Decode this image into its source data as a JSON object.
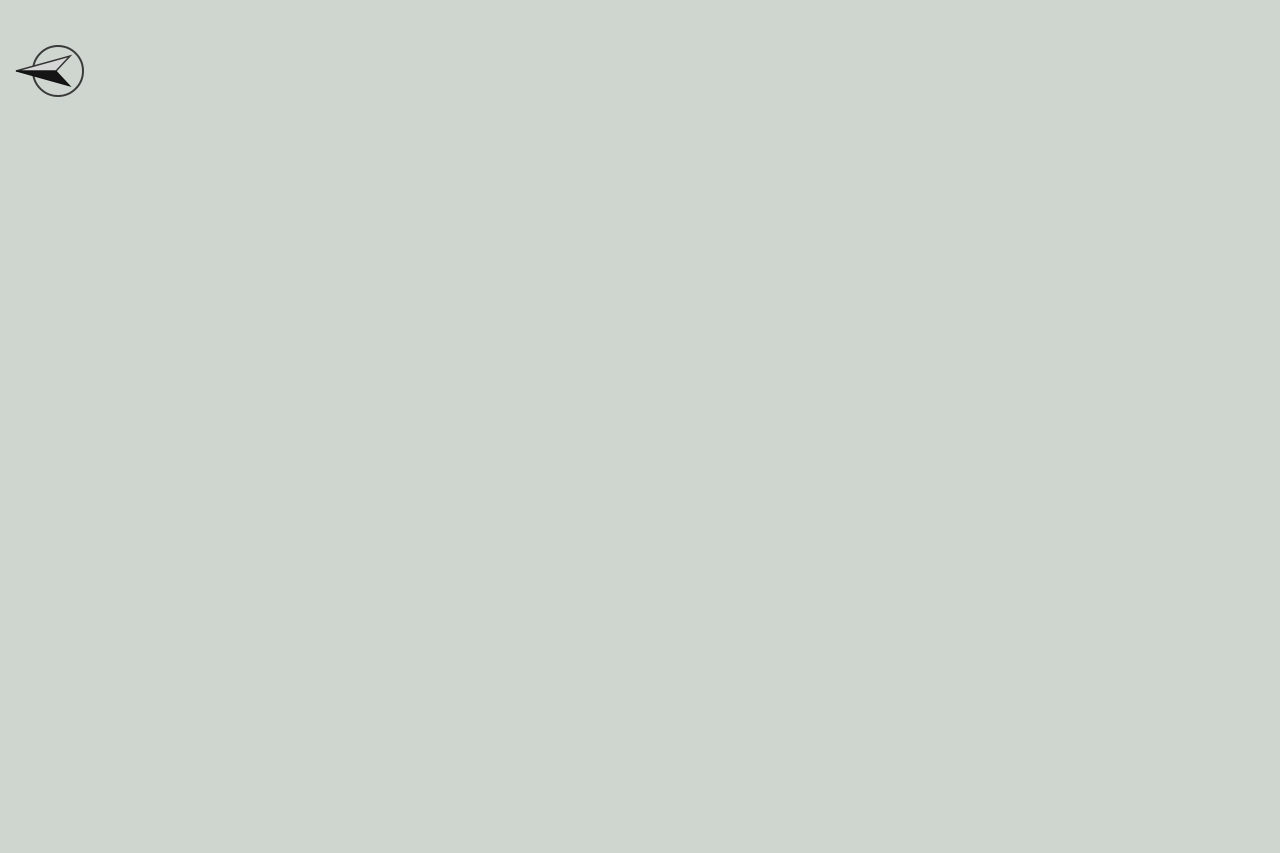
{
  "title": "三湘海尚",
  "compass_label": "N",
  "watermark": "LAND Z",
  "roads": [
    {
      "id": "zhongxin",
      "name": "中心路"
    },
    {
      "id": "anwan",
      "name": "岸湾八街"
    },
    {
      "id": "gongye",
      "name": "工业八路"
    },
    {
      "id": "dongbin",
      "name": "东滨隧道"
    },
    {
      "id": "keyuan",
      "name": "科苑南路"
    }
  ],
  "gates": [
    {
      "id": "west",
      "name": "西门"
    },
    {
      "id": "south",
      "name": "南门"
    },
    {
      "id": "east",
      "name": "东门"
    }
  ],
  "buildings": [
    {
      "id": "A",
      "wing_labels": [
        "A1",
        "A2"
      ],
      "units": [
        "C",
        "A",
        "C",
        "A"
      ]
    },
    {
      "id": "B",
      "wing_labels": [
        "B1",
        "B2"
      ],
      "units": [
        "C",
        "A",
        "C",
        "A"
      ]
    },
    {
      "id": "C",
      "wing_labels": [
        "C1",
        "C2"
      ],
      "units": [
        "C",
        "A",
        "A",
        "B"
      ]
    },
    {
      "id": "D",
      "wing_labels": [
        "D1",
        "D2"
      ],
      "units": [
        "B",
        "A",
        "A",
        "C"
      ]
    },
    {
      "id": "M",
      "wing_labels": [
        "M"
      ],
      "units": [
        "C",
        "A"
      ]
    },
    {
      "id": "N",
      "wing_labels": [
        "N"
      ],
      "units": [
        "C",
        "A"
      ]
    },
    {
      "id": "P",
      "wing_labels": [
        "P"
      ],
      "units": [
        "B",
        "A"
      ]
    },
    {
      "id": "F",
      "wing_labels": [
        "F1",
        "F2"
      ],
      "units": [
        "C",
        "A",
        "C",
        "A"
      ]
    },
    {
      "id": "G",
      "wing_labels": [
        "G栋"
      ],
      "units": [
        "A",
        "B",
        "C",
        "D",
        "E",
        "F",
        "G",
        "H"
      ]
    },
    {
      "id": "H",
      "wing_labels": [
        "H栋"
      ],
      "units": [
        "A",
        "B",
        "C",
        "D",
        "E",
        "F",
        "G"
      ]
    },
    {
      "id": "J",
      "wing_labels": [
        "J栋"
      ],
      "units": [
        "A",
        "B",
        "C",
        "D",
        "E",
        "F",
        "G"
      ]
    },
    {
      "id": "K",
      "wing_labels": [
        "K栋"
      ],
      "units": [
        "A",
        "B",
        "C",
        "D",
        "E",
        "F",
        "G"
      ]
    },
    {
      "id": "L",
      "wing_labels": [
        "L栋"
      ],
      "units": [
        "A",
        "B",
        "C",
        "D",
        "E",
        "F",
        "G",
        "H"
      ]
    }
  ],
  "facilities": [
    {
      "id": "pool",
      "name": "室内游泳池"
    },
    {
      "id": "office_e",
      "name": "E写字楼"
    }
  ],
  "colors": {
    "background": "#cfd6cf",
    "road": "#a2a8a5",
    "site_green": "#6fa04a",
    "lawn_green": "#458a28",
    "building_fill": "#f3e6bd",
    "unit_letter_red": "#c2232a",
    "label_red": "#e02728",
    "path_tan": "#d9b88b",
    "water_blue": "#3f93cf"
  }
}
